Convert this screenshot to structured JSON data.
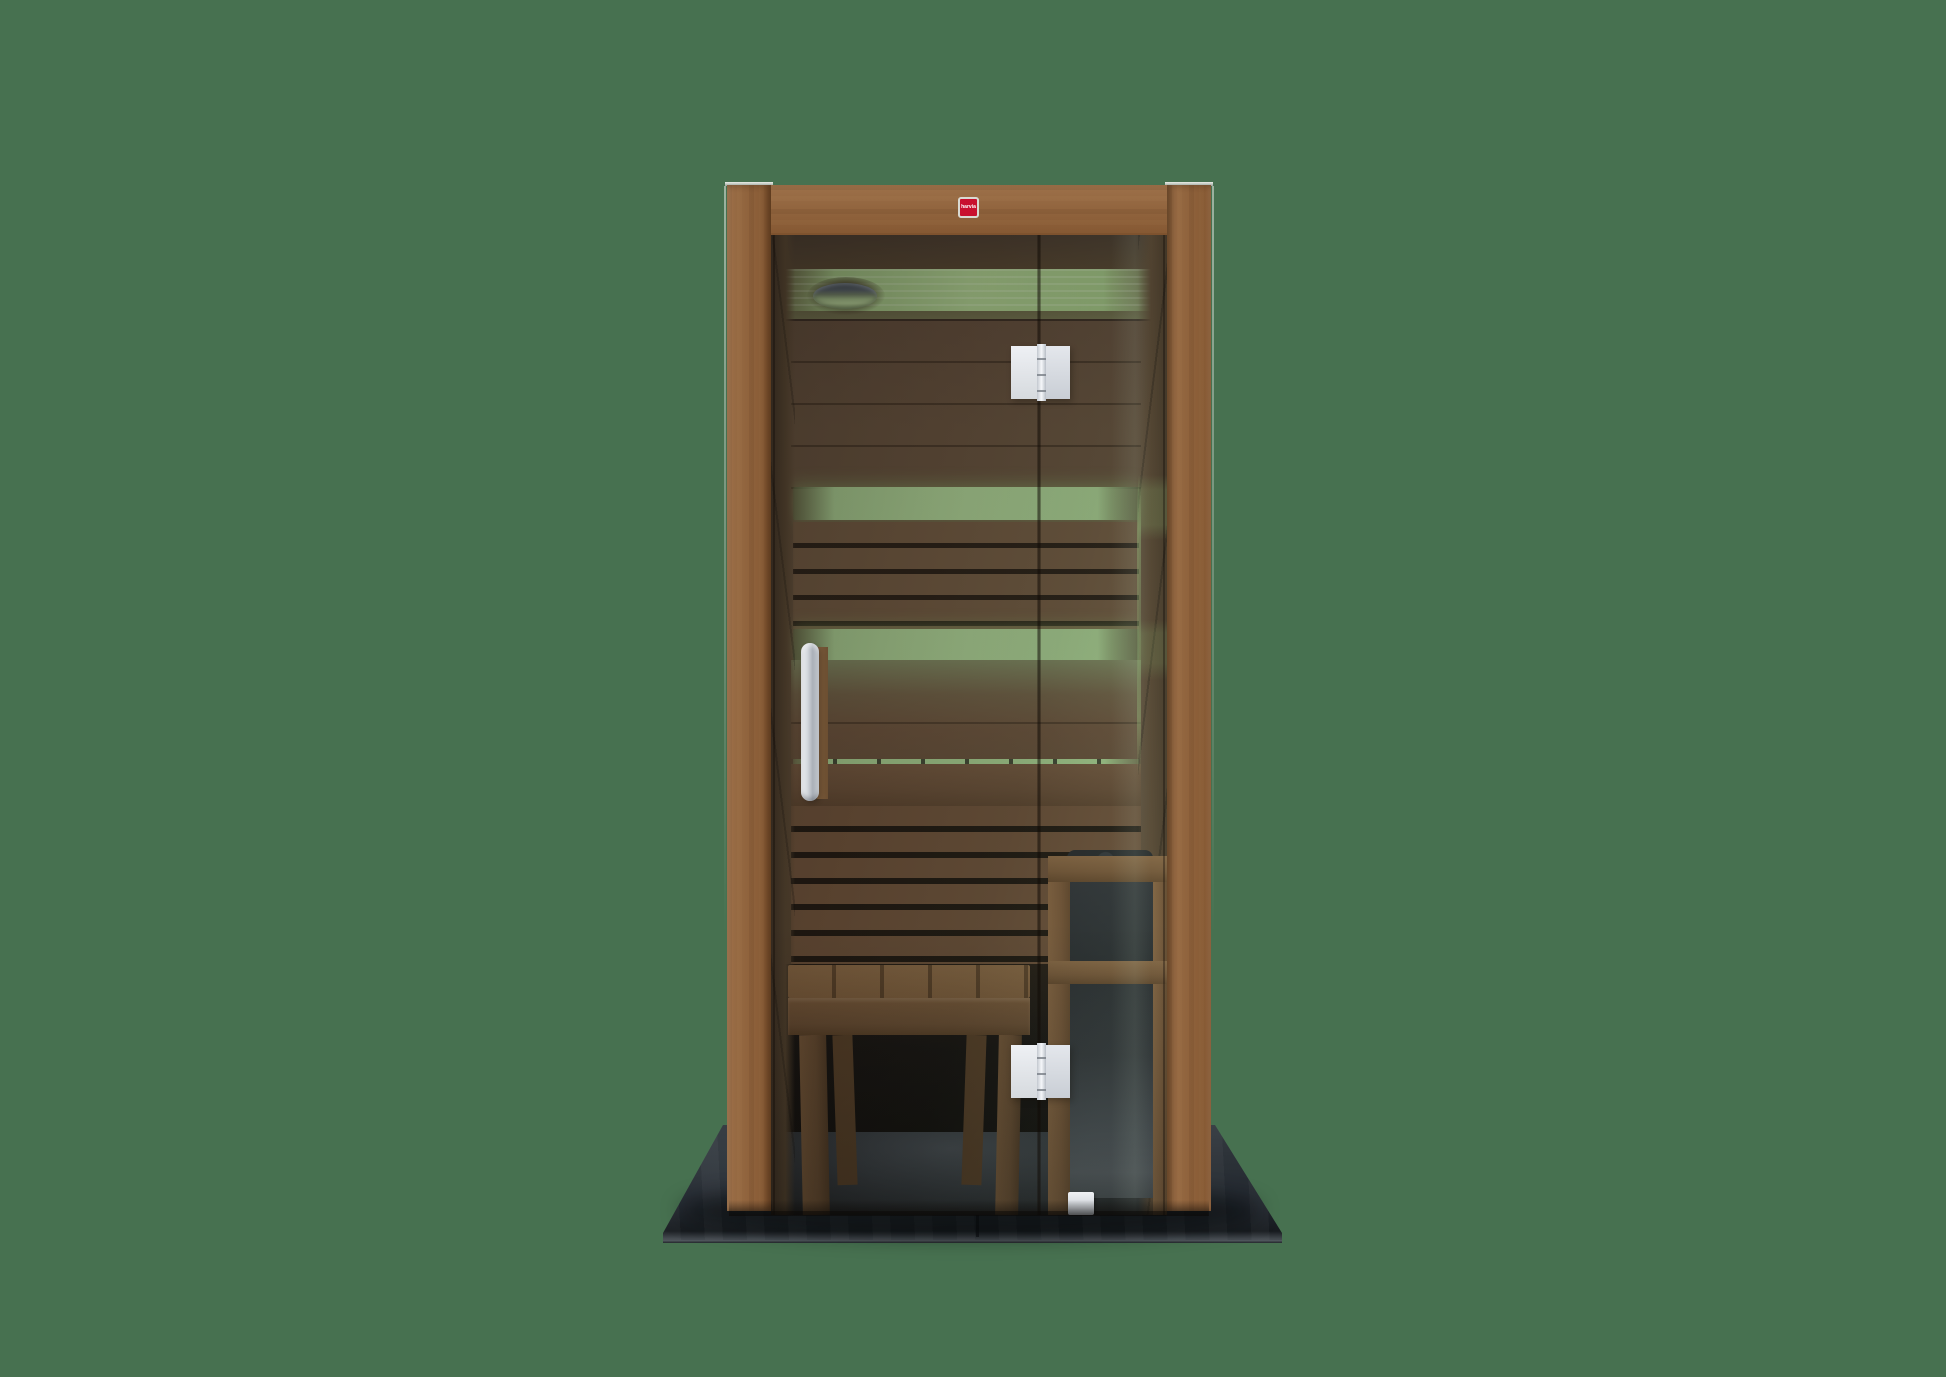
{
  "meta": {
    "description": "Product render of a one-person indoor sauna cabin: walnut-toned wood frame, smoked glass front with door, green LED interior lighting, ceiling dome light, slatted benches, wooden stool, electric heater with stone top and wooden guard rail, standing on a dark slate base against a plain green background"
  },
  "logo": {
    "text": "harvia"
  },
  "colors": {
    "bg": "#477150",
    "wood": "#8d5f38",
    "woodDark": "#6b4426",
    "woodLight": "#a97e4f",
    "logoRed": "#c8102e",
    "ledGreen": "#a6cb8f",
    "slate": "#2a3036",
    "metal": "#e8ebef",
    "glassShadow": "#1a1511"
  },
  "parts": {
    "base": "slate floor base",
    "frame": "wood frame",
    "door": "glass door",
    "fixed_panel": "fixed glass panel",
    "handle": "door handle",
    "hinges": "door hinges",
    "ceiling_light": "dome ceiling light",
    "led_strips": "green LED light strips",
    "backrest": "backrest slats",
    "bench": "lower bench",
    "stool": "wooden stool",
    "heater": "electric sauna heater",
    "heater_guard": "heater guard rail",
    "stones": "sauna stones"
  }
}
